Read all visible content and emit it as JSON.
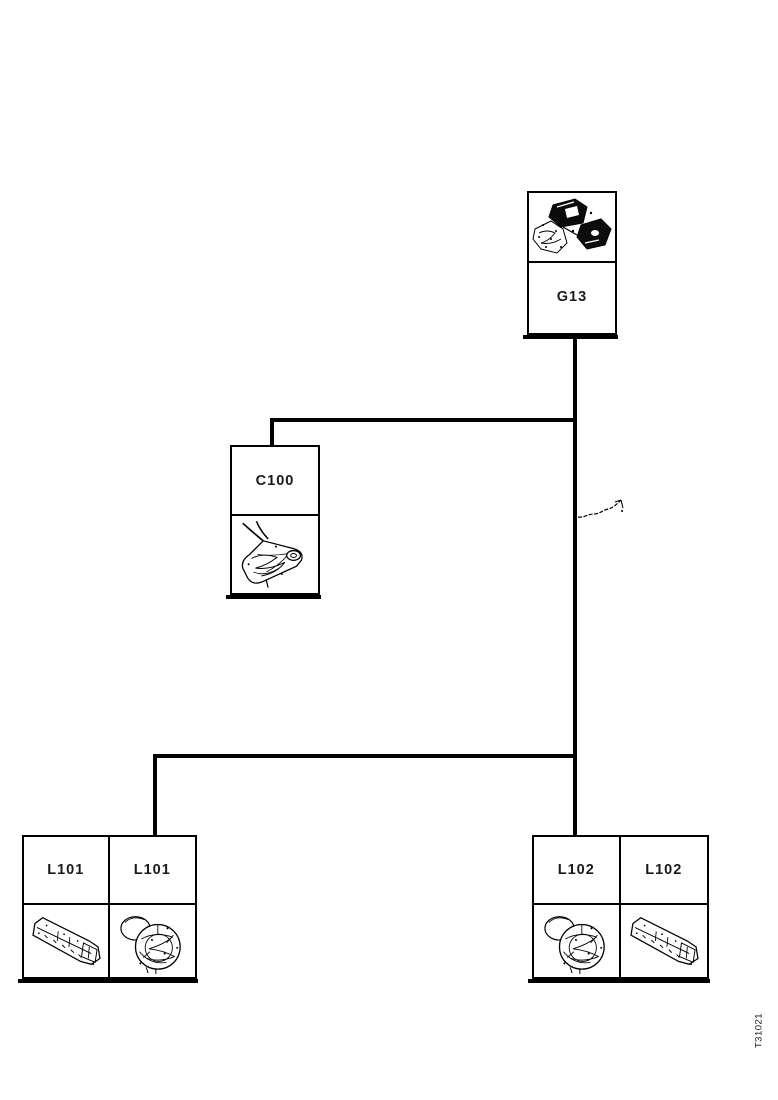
{
  "page": {
    "background_color": "#ffffff",
    "line_color": "#000000",
    "description": "Scanned wiring harness overview diagram"
  },
  "nodes": {
    "g13": {
      "label": "G13",
      "icon": "engine-assembly-icon"
    },
    "c100": {
      "label": "C100",
      "icon": "harness-connector-icon"
    },
    "l101_left": {
      "label": "L101",
      "icon": "strip-connector-icon"
    },
    "l101_right": {
      "label": "L101",
      "icon": "round-connector-icon"
    },
    "l102_left": {
      "label": "L102",
      "icon": "round-connector-icon"
    },
    "l102_right": {
      "label": "L102",
      "icon": "strip-connector-icon"
    }
  },
  "icons": {
    "g13": "engine-assembly-icon",
    "c100": "harness-connector-icon",
    "l101_left": "strip-connector-icon",
    "l101_right": "round-connector-icon",
    "l102_left": "round-connector-icon",
    "l102_right": "strip-connector-icon",
    "annotation": "handwritten-arrow-icon"
  },
  "footer": {
    "drawing_code": "T31021"
  }
}
